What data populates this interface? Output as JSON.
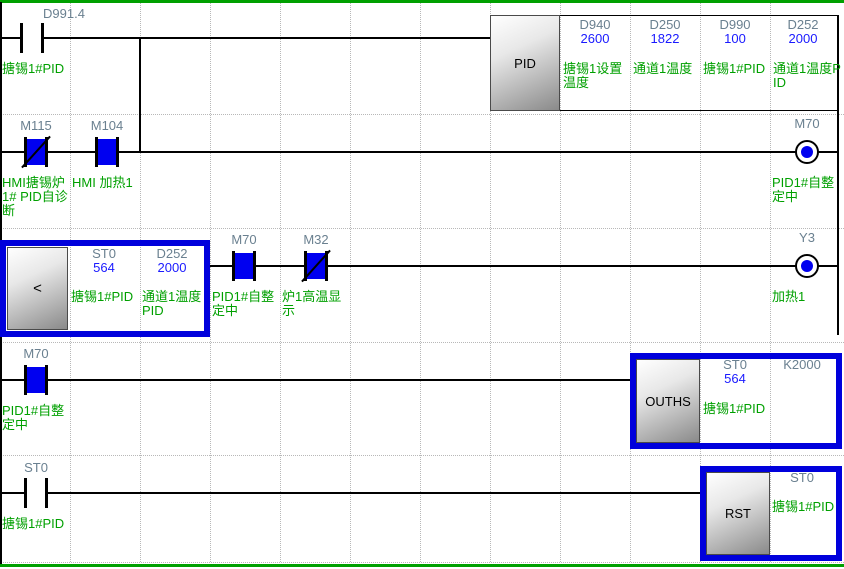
{
  "colors": {
    "energized_fill": "#0000f0",
    "active_block_border": "#0000dc",
    "comment_green": "#00a000",
    "monitor_value_blue": "#1a1aff",
    "device_label_gray": "#6a8090",
    "separator_green": "#00a000"
  },
  "rung1": {
    "contact": {
      "device": "D991.4",
      "comment": "搪锡1#PID"
    },
    "pid": {
      "label": "PID",
      "operands": [
        {
          "device": "D940",
          "value": "2600",
          "comment": "搪锡1设置温度"
        },
        {
          "device": "D250",
          "value": "1822",
          "comment": "通道1温度"
        },
        {
          "device": "D990",
          "value": "100",
          "comment": "搪锡1#PID"
        },
        {
          "device": "D252",
          "value": "2000",
          "comment": "通道1温度PID"
        }
      ]
    }
  },
  "rung2": {
    "contact_m115": {
      "device": "M115",
      "comment": "HMI搪锡炉1# PID自诊断"
    },
    "contact_m104": {
      "device": "M104",
      "comment": "HMI 加热1"
    },
    "coil": {
      "device": "M70",
      "comment": "PID1#自整定中"
    }
  },
  "rung3": {
    "compare": {
      "label": "<",
      "operands": [
        {
          "device": "ST0",
          "value": "564",
          "comment": "搪锡1#PID"
        },
        {
          "device": "D252",
          "value": "2000",
          "comment": "通道1温度PID"
        }
      ]
    },
    "contact_m70": {
      "device": "M70",
      "comment": "PID1#自整定中"
    },
    "contact_m32": {
      "device": "M32",
      "comment": "炉1高温显示"
    },
    "coil": {
      "device": "Y3",
      "comment": "加热1"
    }
  },
  "rung4": {
    "contact": {
      "device": "M70",
      "comment": "PID1#自整定中"
    },
    "ouths": {
      "label": "OUTHS",
      "operands": [
        {
          "device": "ST0",
          "value": "564",
          "comment": "搪锡1#PID"
        },
        {
          "device": "K2000",
          "value": "",
          "comment": ""
        }
      ]
    }
  },
  "rung5": {
    "contact": {
      "device": "ST0",
      "comment": "搪锡1#PID"
    },
    "rst": {
      "label": "RST",
      "operands": [
        {
          "device": "ST0",
          "comment": "搪锡1#PID"
        }
      ]
    }
  }
}
